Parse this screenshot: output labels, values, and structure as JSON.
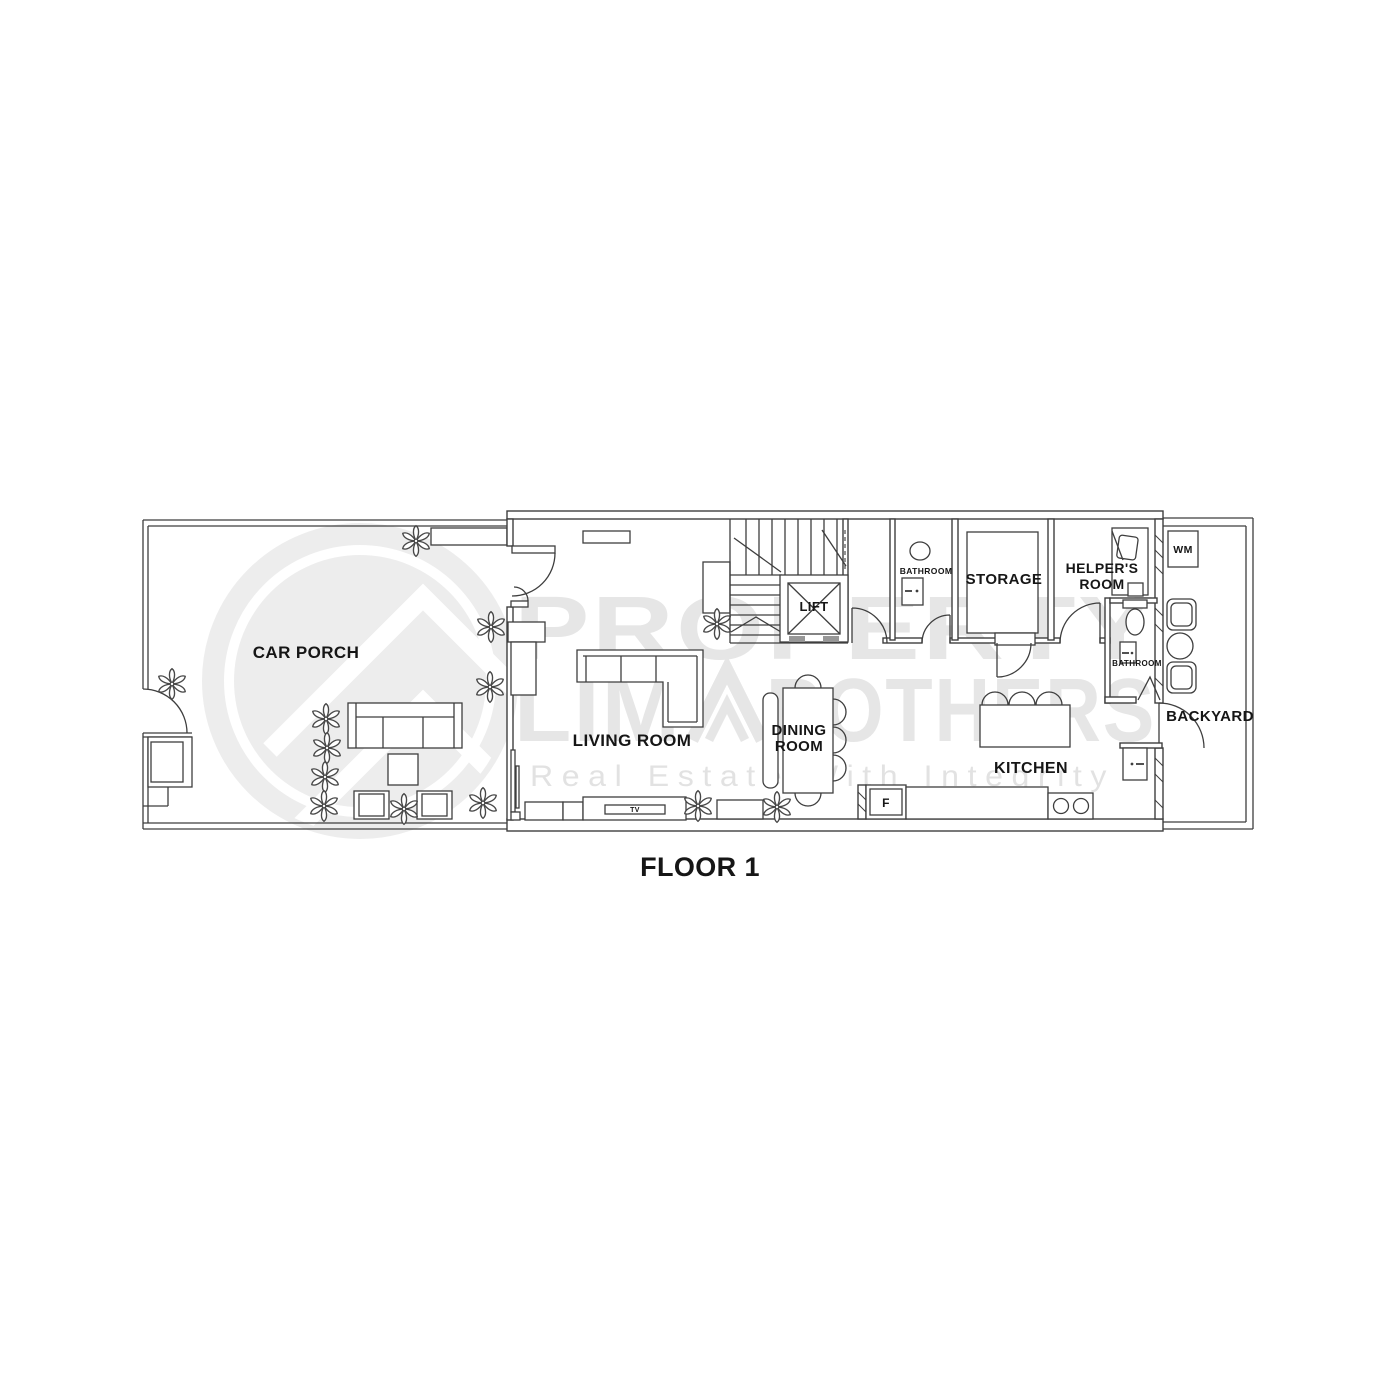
{
  "title": "FLOOR 1",
  "watermark": {
    "brand_line1": "PROPERTY",
    "brand_line2_left": "LIM",
    "brand_line2_right": "ROTHERS",
    "tagline": "Real Estate With Integrity"
  },
  "labels": {
    "car_porch": "CAR PORCH",
    "living_room": "LIVING ROOM",
    "dining_room": {
      "line1": "DINING",
      "line2": "ROOM"
    },
    "lift": "LIFT",
    "bathroom_1": "BATHROOM",
    "storage": "STORAGE",
    "helpers_room": {
      "line1": "HELPER'S",
      "line2": "ROOM"
    },
    "washing_machine": "WM",
    "bathroom_2": "BATHROOM",
    "backyard": "BACKYARD",
    "kitchen": "KITCHEN",
    "fridge": "F",
    "tv": "TV"
  },
  "colors": {
    "background": "#ffffff",
    "plan_line": "#3e3e3e",
    "label_text": "#161616",
    "watermark": "#e6e6e6"
  }
}
